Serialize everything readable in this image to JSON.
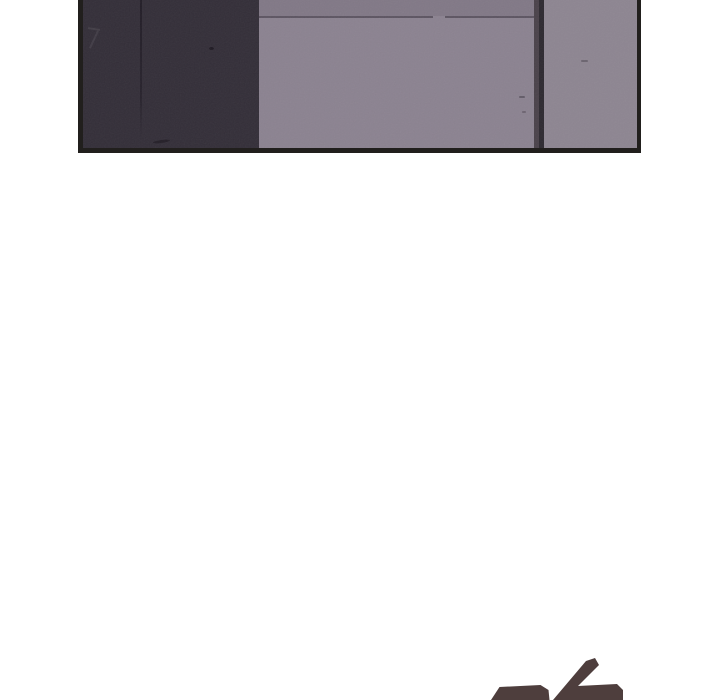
{
  "page": {
    "background_color": "#ffffff"
  },
  "comic_panel": {
    "description": "bottom portion of a webtoon panel showing flat interior wall corners, cropped by the top of the viewport",
    "border_color": "#211f1d",
    "left_wall_color": "#332e38",
    "center_wall_color": "#8b8290",
    "right_wall_color": "#8d8591",
    "divider_color": "#4a424a",
    "divider_shadow_color": "#2d2930",
    "ceiling_line_color": "#5d5562"
  },
  "episode_number_fragment": {
    "description": "top edge of large stylized numerals scrolling into view at the bottom-right",
    "color": "#4e3e3d"
  }
}
